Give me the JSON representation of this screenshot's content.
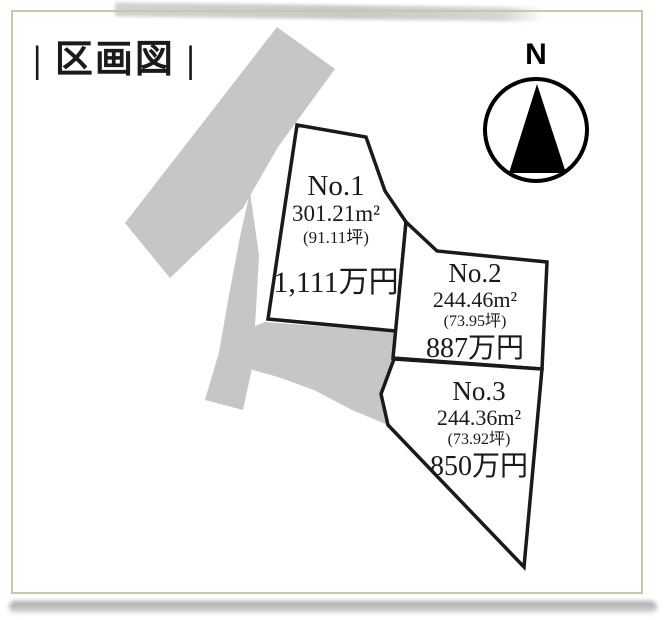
{
  "title": "| 区画図 |",
  "compass": {
    "label": "N"
  },
  "lots": [
    {
      "name": "No.1",
      "area_m2": "301.21m²",
      "area_tsubo": "(91.11坪)",
      "price": "1,111万円"
    },
    {
      "name": "No.2",
      "area_m2": "244.46m²",
      "area_tsubo": "(73.95坪)",
      "price": "887万円"
    },
    {
      "name": "No.3",
      "area_m2": "244.36m²",
      "area_tsubo": "(73.92坪)",
      "price": "850万円"
    }
  ],
  "colors": {
    "road-gray": "#c6c6c6",
    "frame-tan": "#ccc5a6",
    "ink-black": "#1a1a1a",
    "lot-fill": "#ffffff"
  }
}
